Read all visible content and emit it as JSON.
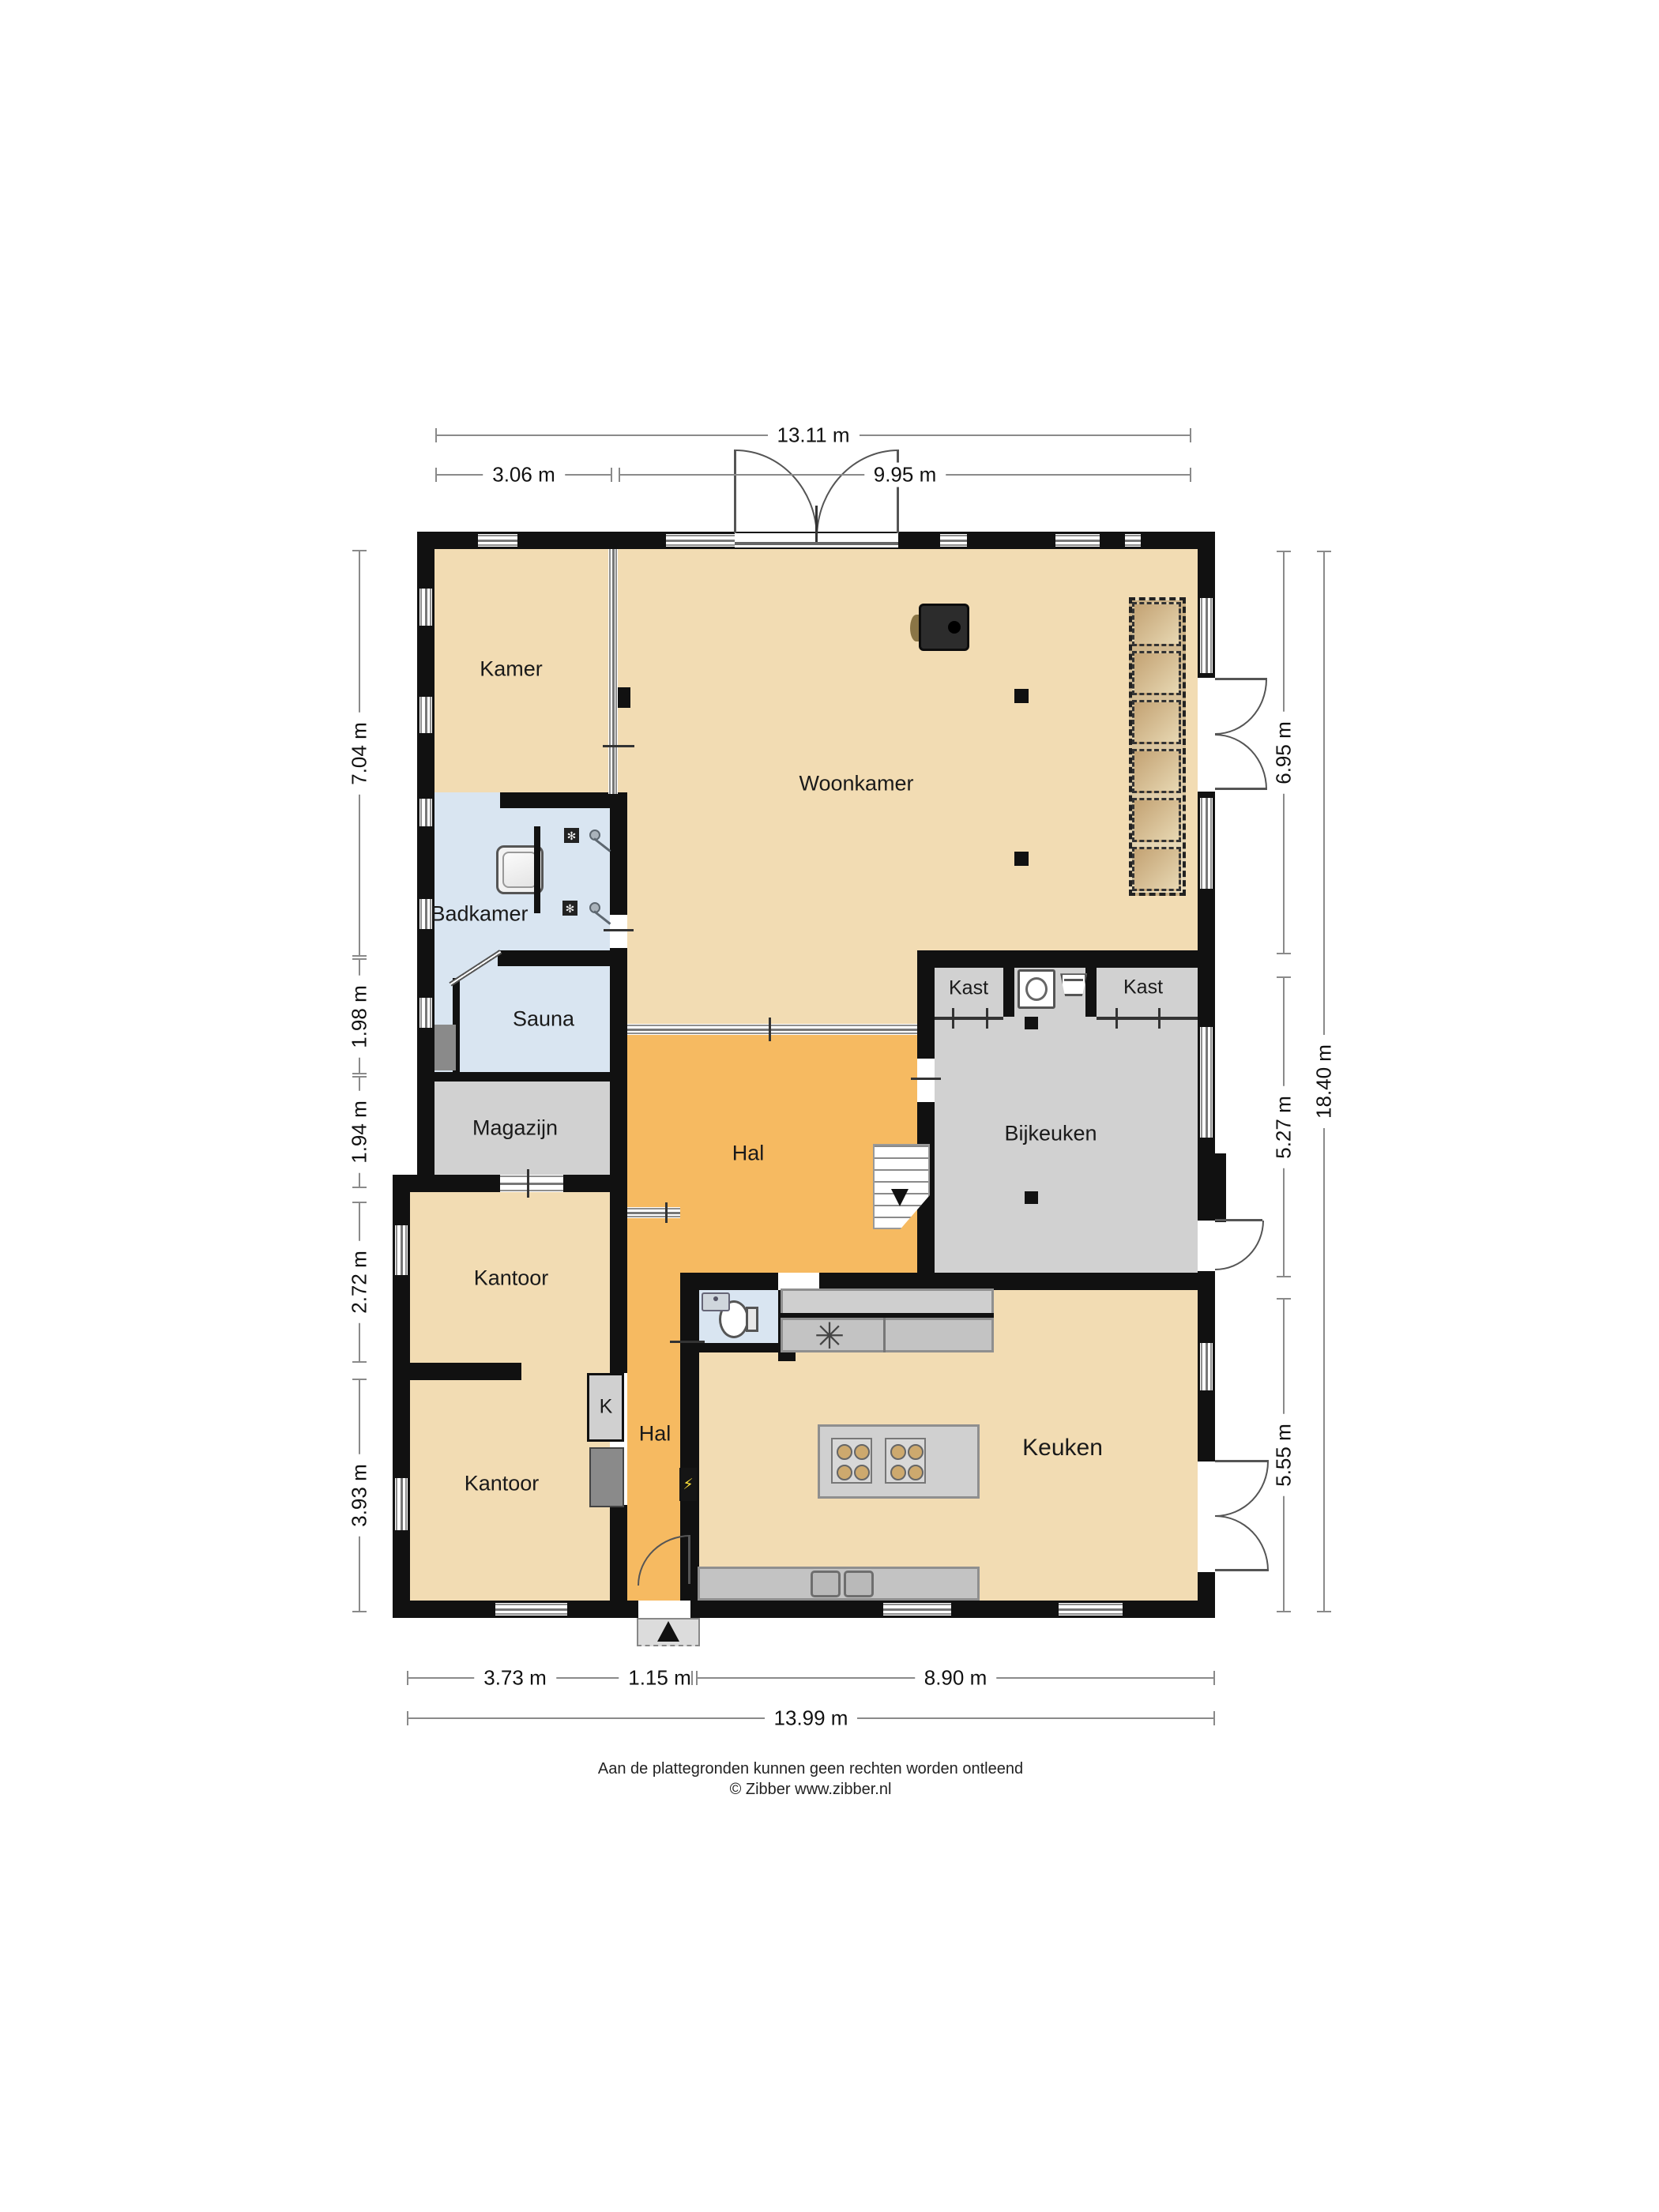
{
  "rooms": {
    "kamer": {
      "label": "Kamer"
    },
    "woonkamer": {
      "label": "Woonkamer"
    },
    "badkamer": {
      "label": "Badkamer"
    },
    "sauna": {
      "label": "Sauna"
    },
    "magazijn": {
      "label": "Magazijn"
    },
    "hal_boven": {
      "label": "Hal"
    },
    "kast_links": {
      "label": "Kast"
    },
    "kast_rechts": {
      "label": "Kast"
    },
    "bijkeuken": {
      "label": "Bijkeuken"
    },
    "kantoor_boven": {
      "label": "Kantoor"
    },
    "kantoor_onder": {
      "label": "Kantoor"
    },
    "kast_k": {
      "label": "K"
    },
    "hal_onder": {
      "label": "Hal"
    },
    "keuken": {
      "label": "Keuken"
    }
  },
  "dimensions": {
    "top": {
      "total": "13.11 m",
      "left": "3.06 m",
      "right": "9.95 m"
    },
    "left": {
      "d1": "7.04 m",
      "d2": "1.98 m",
      "d3": "1.94 m",
      "d4": "2.72 m",
      "d5": "3.93 m"
    },
    "right": {
      "d1": "6.95 m",
      "d2": "5.27 m",
      "d3": "5.55 m",
      "total": "18.40 m"
    },
    "bottom": {
      "d1": "3.73 m",
      "d2": "1.15 m",
      "d3": "8.90 m",
      "total": "13.99 m"
    }
  },
  "icons": {
    "vent": "✻",
    "extractor_fan": "✳",
    "electric_panel": "⚡"
  },
  "footer": {
    "line1": "Aan de plattegronden kunnen geen rechten worden ontleend",
    "line2": "© Zibber www.zibber.nl"
  },
  "colors": {
    "wall": "#111111",
    "tan": "#f2dcb3",
    "orange": "#f6ba61",
    "blue": "#d9e5f1",
    "gray": "#d1d1d1",
    "dim": "#8a8a8a"
  }
}
